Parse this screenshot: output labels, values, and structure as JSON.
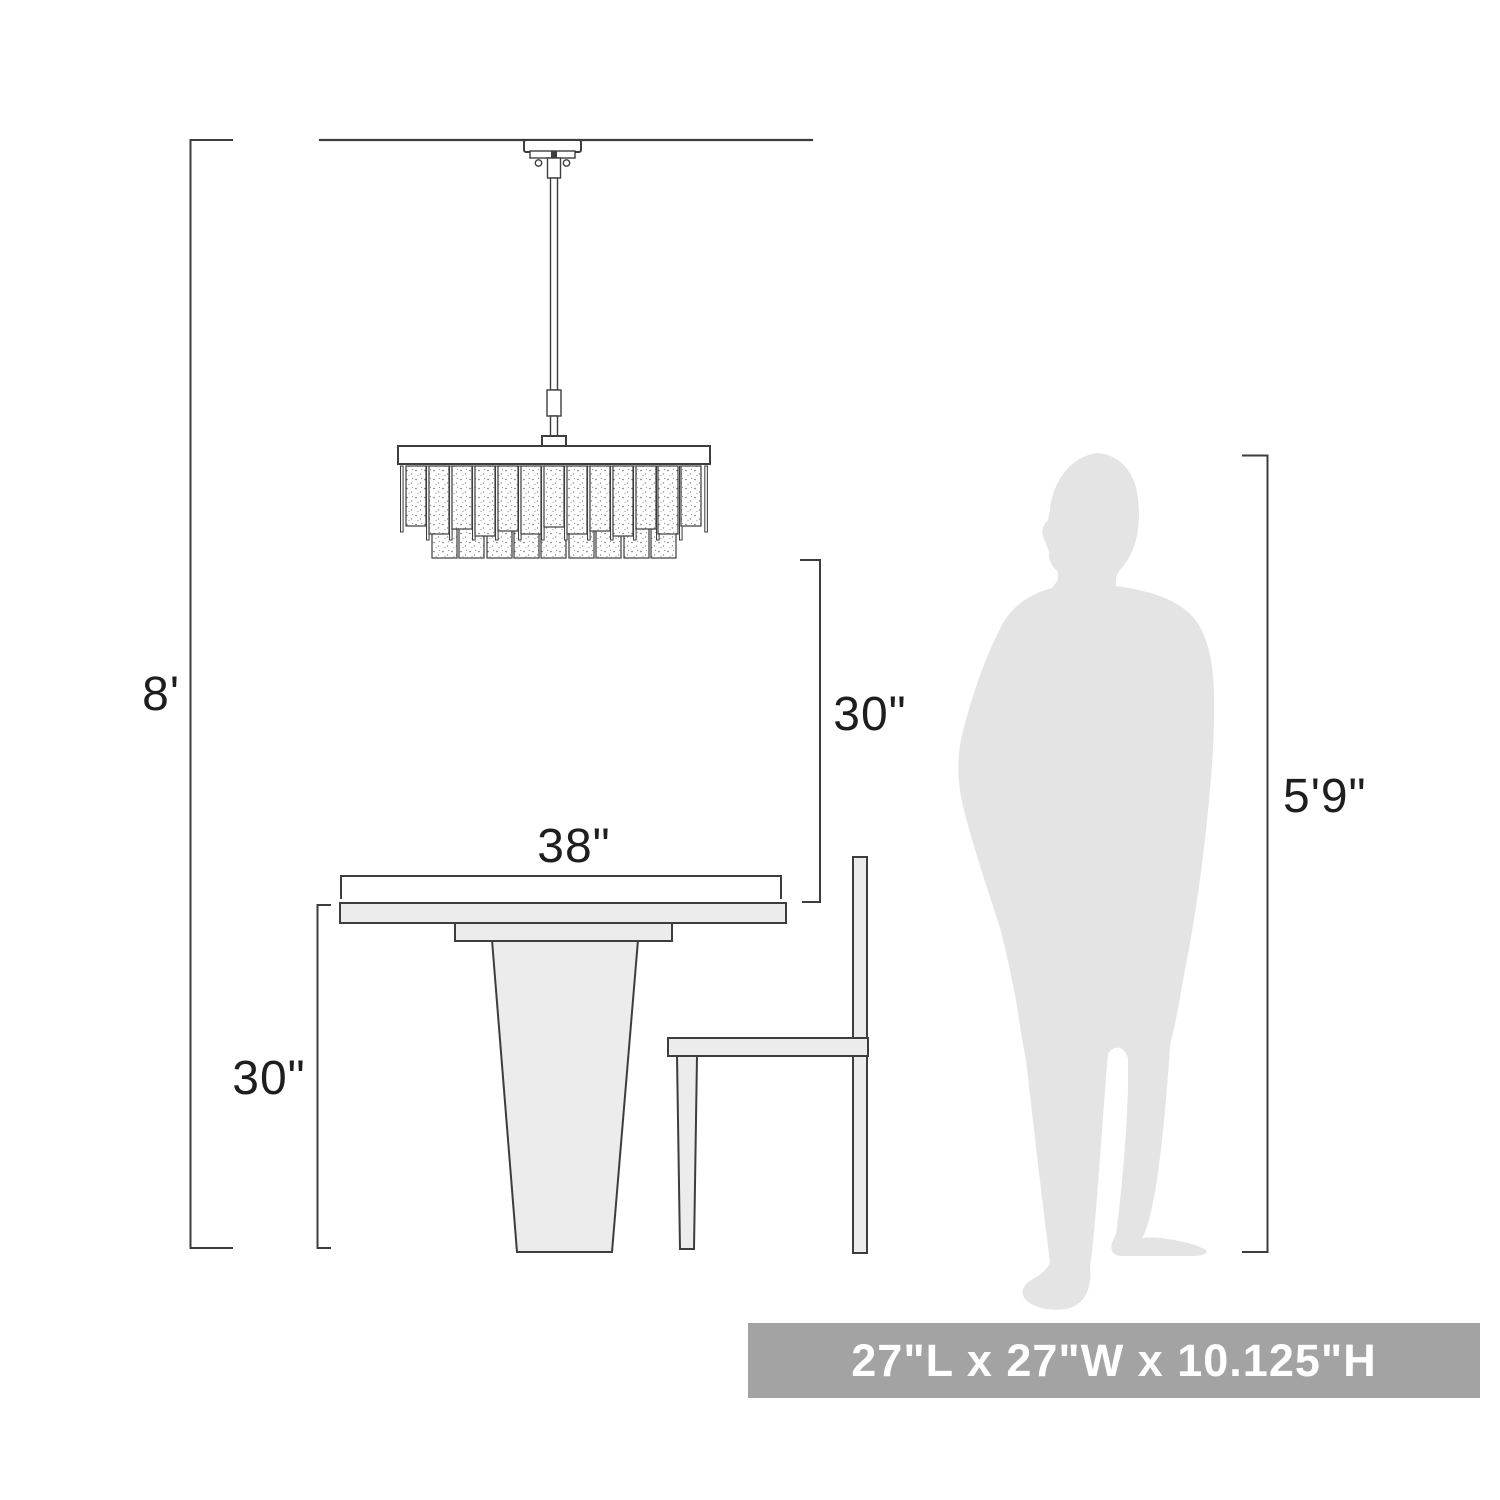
{
  "diagram": {
    "labels": {
      "ceiling_height": "8'",
      "hang_clearance": "30\"",
      "table_width": "38\"",
      "table_height": "30\"",
      "person_height": "5'9\""
    },
    "banner": {
      "fixture_size": "27\"L x 27\"W x 10.125\"H"
    },
    "colors": {
      "line": "#3d3d3d",
      "furniture_fill": "#ececec",
      "silhouette": "#e4e4e5",
      "banner_bg": "#a3a3a3",
      "banner_text": "#ffffff",
      "label_text": "#1e1e1e"
    }
  }
}
